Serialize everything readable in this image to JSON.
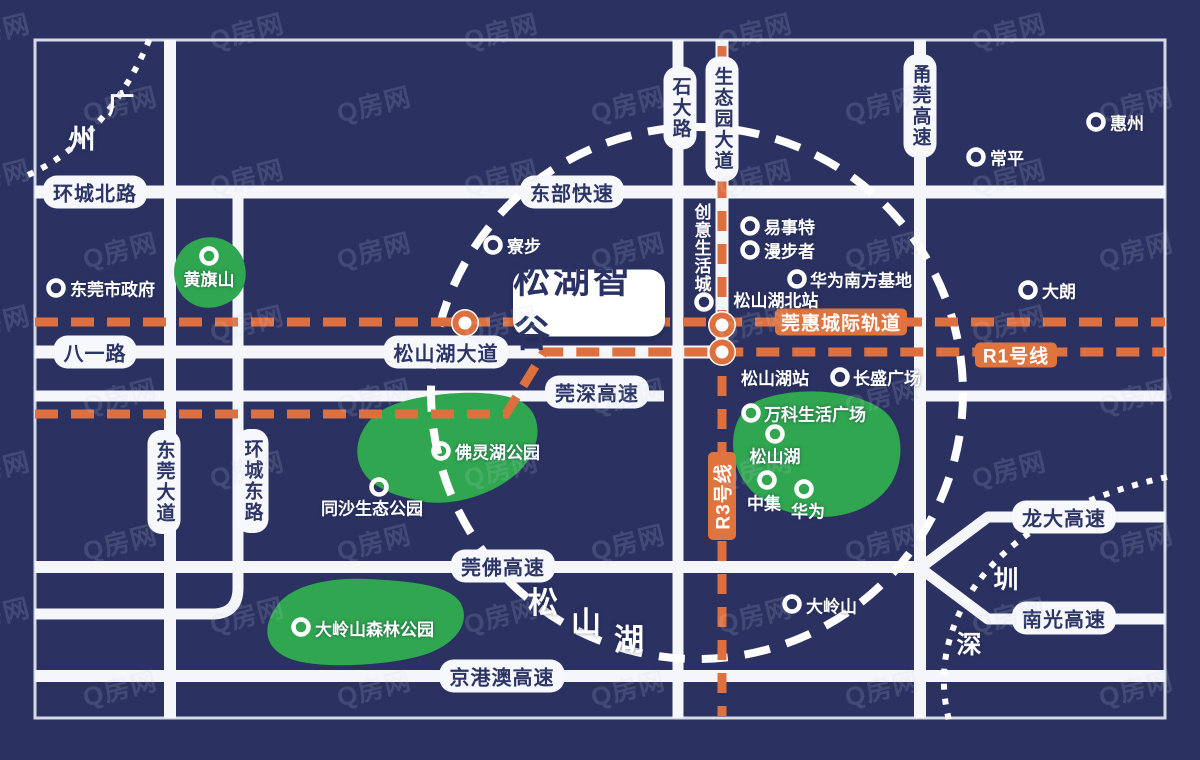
{
  "colors": {
    "bg": "#2b3262",
    "road": "#f5f6fa",
    "frame": "#e9ecf6",
    "park": "#2fa64f",
    "rail": "#de7040",
    "navy": "#2c3566",
    "white": "#ffffff",
    "watermark": "#ccd5ea"
  },
  "watermark": {
    "text": "Q房网"
  },
  "project": {
    "label": "松湖智谷",
    "x": 589,
    "y": 303,
    "w": 152,
    "h": 67
  },
  "geometry": {
    "frame": {
      "x": 35,
      "y": 40,
      "w": 1130,
      "h": 678
    },
    "roads": [
      {
        "name": "ring-north-road",
        "d": "M35,192 H1165",
        "w": 13
      },
      {
        "name": "songshanhu-avenue-road",
        "d": "M35,352 H726",
        "w": 13
      },
      {
        "name": "guanshen-expwy-road",
        "d": "M35,396 H664",
        "w": 11
      },
      {
        "name": "east-stub-road",
        "d": "M920,396 H1165",
        "w": 11
      },
      {
        "name": "guanfo-expwy-road",
        "d": "M35,567 H921",
        "w": 12
      },
      {
        "name": "huancheng-east-road",
        "d": "M35,614 H212 Q238,614 238,588 V198",
        "w": 11
      },
      {
        "name": "jinggangao-expwy-road",
        "d": "M35,676 H1165",
        "w": 12
      },
      {
        "name": "dongguan-avenue-road",
        "d": "M170,40 V718",
        "w": 12
      },
      {
        "name": "shida-road",
        "d": "M678,40 V718",
        "w": 11
      },
      {
        "name": "shengtaiyuan-avenue-road",
        "d": "M722,40 V354",
        "w": 13
      },
      {
        "name": "yongguan-expwy-road",
        "d": "M920,40 V718",
        "w": 12
      },
      {
        "name": "longda-branch-road",
        "d": "M920,568 L988,517 H1165",
        "w": 11
      },
      {
        "name": "nanguang-branch-road",
        "d": "M920,568 L988,619 H1165",
        "w": 11
      }
    ],
    "parks": [
      {
        "name": "huangqishan-park",
        "d": "M196,240 C216,232 238,242 244,262 C250,284 240,300 220,306 C200,312 182,302 176,284 C170,266 178,247 196,240 Z"
      },
      {
        "name": "folinghu-park",
        "d": "M395,404 C430,392 490,388 518,400 C544,412 542,444 524,466 C500,494 452,508 420,501 C396,496 378,490 366,476 C352,458 356,436 370,420 C380,410 386,408 395,404 Z"
      },
      {
        "name": "songshanhu-lake",
        "d": "M762,399 C800,386 852,390 880,408 C903,423 906,456 892,482 C874,512 832,523 796,514 C764,506 744,490 736,464 C728,436 736,408 762,399 Z"
      },
      {
        "name": "dalingshan-park",
        "d": "M276,607 C290,585 330,577 368,579 C406,581 448,584 460,602 C472,622 456,646 420,656 C384,666 312,670 286,657 C262,645 264,625 276,607 Z"
      }
    ],
    "dashed_circle": {
      "cx": 697,
      "cy": 393,
      "r": 266,
      "w": 8,
      "dash": "26 17"
    },
    "boundaries": [
      {
        "name": "guangzhou-boundary",
        "d": "M28,175 C85,150 127,95 150,38"
      },
      {
        "name": "shenzhen-boundary",
        "d": "M1167,477 C1075,497 1002,537 965,602 C944,641 938,680 950,724"
      }
    ],
    "rails": [
      {
        "name": "guanhui-rail-line",
        "d": "M35,322 H1165",
        "dash": "23 13"
      },
      {
        "name": "r1-line",
        "d": "M35,414 H506 L544,352 H1165",
        "dash": "23 13"
      },
      {
        "name": "r3-line",
        "d": "M722,46 V716",
        "dash": "20 13"
      }
    ],
    "stations": [
      {
        "x": 465,
        "y": 323
      },
      {
        "x": 722,
        "y": 325
      },
      {
        "x": 722,
        "y": 352
      }
    ]
  },
  "rail_badges": [
    {
      "id": "guanhui-rail-badge",
      "label": "莞惠城际轨道",
      "x": 841,
      "y": 322,
      "w": 132,
      "h": 27,
      "vertical": false
    },
    {
      "id": "r1-line-badge",
      "label": "R1号线",
      "x": 1016,
      "y": 355,
      "w": 82,
      "h": 25,
      "vertical": false
    },
    {
      "id": "r3-line-badge",
      "label": "R3号线",
      "x": 722,
      "y": 496,
      "w": 28,
      "h": 88,
      "vertical": true
    }
  ],
  "road_labels": [
    {
      "id": "huancheng-north-label",
      "label": "环城北路",
      "x": 95,
      "y": 192
    },
    {
      "id": "dongbu-express-label",
      "label": "东部快速",
      "x": 572,
      "y": 192
    },
    {
      "id": "bayi-road-label",
      "label": "八一路",
      "x": 95,
      "y": 352
    },
    {
      "id": "songshanhu-avenue-label",
      "label": "松山湖大道",
      "x": 446,
      "y": 352
    },
    {
      "id": "guanshen-expwy-label",
      "label": "莞深高速",
      "x": 597,
      "y": 392
    },
    {
      "id": "guanfo-expwy-label",
      "label": "莞佛高速",
      "x": 503,
      "y": 566
    },
    {
      "id": "jinggangao-expwy-label",
      "label": "京港澳高速",
      "x": 502,
      "y": 676
    },
    {
      "id": "longda-expwy-label",
      "label": "龙大高速",
      "x": 1064,
      "y": 517
    },
    {
      "id": "nanguang-expwy-label",
      "label": "南光高速",
      "x": 1064,
      "y": 618
    }
  ],
  "road_labels_vertical": [
    {
      "id": "shida-road-label",
      "label": "石大路",
      "x": 680,
      "y": 108
    },
    {
      "id": "shengtaiyuan-avenue-label",
      "label": "生态园大道",
      "x": 722,
      "y": 119
    },
    {
      "id": "yongguan-expwy-label",
      "label": "甬莞高速",
      "x": 920,
      "y": 106
    },
    {
      "id": "dongguan-avenue-label",
      "label": "东莞大道",
      "x": 164,
      "y": 482
    },
    {
      "id": "huancheng-east-label",
      "label": "环城东路",
      "x": 252,
      "y": 481
    }
  ],
  "pois": [
    {
      "id": "dongguan-government",
      "label": "东莞市政府",
      "rx": 56,
      "ry": 288,
      "tx": 70,
      "ty": 288,
      "anchor": "right"
    },
    {
      "id": "liaobu",
      "label": "寮步",
      "rx": 493,
      "ry": 245,
      "tx": 507,
      "ty": 245,
      "anchor": "right"
    },
    {
      "id": "huangqishan",
      "label": "黄旗山",
      "rx": 209,
      "ry": 256,
      "tx": 209,
      "ty": 278,
      "anchor": "center"
    },
    {
      "id": "huizhou",
      "label": "惠州",
      "rx": 1096,
      "ry": 122,
      "tx": 1110,
      "ty": 122,
      "anchor": "right"
    },
    {
      "id": "changping",
      "label": "常平",
      "rx": 976,
      "ry": 157,
      "tx": 990,
      "ty": 157,
      "anchor": "right"
    },
    {
      "id": "dalang",
      "label": "大朗",
      "rx": 1028,
      "ry": 290,
      "tx": 1042,
      "ty": 290,
      "anchor": "right"
    },
    {
      "id": "yishite",
      "label": "易事特",
      "rx": 750,
      "ry": 226,
      "tx": 764,
      "ty": 226,
      "anchor": "right"
    },
    {
      "id": "manbuzhe",
      "label": "漫步者",
      "rx": 750,
      "ry": 250,
      "tx": 764,
      "ty": 250,
      "anchor": "right"
    },
    {
      "id": "huawei-south-base",
      "label": "华为南方基地",
      "rx": 797,
      "ry": 279,
      "tx": 810,
      "ty": 279,
      "anchor": "right"
    },
    {
      "id": "changsheng-plaza",
      "label": "长盛广场",
      "rx": 840,
      "ry": 377,
      "tx": 853,
      "ty": 377,
      "anchor": "right"
    },
    {
      "id": "vanke-life-plaza",
      "label": "万科生活广场",
      "rx": 751,
      "ry": 413,
      "tx": 764,
      "ty": 413,
      "anchor": "right"
    },
    {
      "id": "songshanhu-poi",
      "label": "松山湖",
      "rx": 775,
      "ry": 434,
      "tx": 775,
      "ty": 455,
      "anchor": "center"
    },
    {
      "id": "zhongji",
      "label": "中集",
      "rx": 767,
      "ry": 480,
      "tx": 764,
      "ty": 502,
      "anchor": "center"
    },
    {
      "id": "huawei",
      "label": "华为",
      "rx": 804,
      "ry": 489,
      "tx": 808,
      "ty": 510,
      "anchor": "center"
    },
    {
      "id": "folinghu-park-poi",
      "label": "佛灵湖公园",
      "rx": 441,
      "ry": 451,
      "tx": 455,
      "ty": 451,
      "anchor": "right"
    },
    {
      "id": "tongsha-eco-park",
      "label": "同沙生态公园",
      "rx": 379,
      "ry": 487,
      "tx": 372,
      "ty": 507,
      "anchor": "center"
    },
    {
      "id": "dalingshan-forest-park",
      "label": "大岭山森林公园",
      "rx": 301,
      "ry": 627,
      "tx": 315,
      "ty": 628,
      "anchor": "right"
    },
    {
      "id": "dalingshan",
      "label": "大岭山",
      "rx": 792,
      "ry": 604,
      "tx": 806,
      "ty": 605,
      "anchor": "right"
    }
  ],
  "texts": [
    {
      "id": "guangzhou-char-1",
      "label": "广",
      "x": 121,
      "y": 102,
      "size": 27
    },
    {
      "id": "guangzhou-char-2",
      "label": "州",
      "x": 82,
      "y": 137,
      "size": 27
    },
    {
      "id": "shenzhen-char-1",
      "label": "圳",
      "x": 1006,
      "y": 578,
      "size": 25
    },
    {
      "id": "shenzhen-char-2",
      "label": "深",
      "x": 969,
      "y": 643,
      "size": 25
    },
    {
      "id": "songshanhu-char-1",
      "label": "松",
      "x": 543,
      "y": 600,
      "size": 30
    },
    {
      "id": "songshanhu-char-2",
      "label": "山",
      "x": 586,
      "y": 620,
      "size": 30
    },
    {
      "id": "songshanhu-char-3",
      "label": "湖",
      "x": 629,
      "y": 637,
      "size": 30
    },
    {
      "id": "songshanhu-north-station",
      "label": "松山湖北站",
      "x": 776,
      "y": 299,
      "size": 17
    },
    {
      "id": "songshanhu-station",
      "label": "松山湖站",
      "x": 775,
      "y": 377,
      "size": 17
    }
  ],
  "vertical_poi": {
    "id": "chuangyi-shenghuocheng",
    "label": "创意生活城",
    "x": 701,
    "y": 248,
    "ring": {
      "x": 704,
      "y": 302
    }
  }
}
